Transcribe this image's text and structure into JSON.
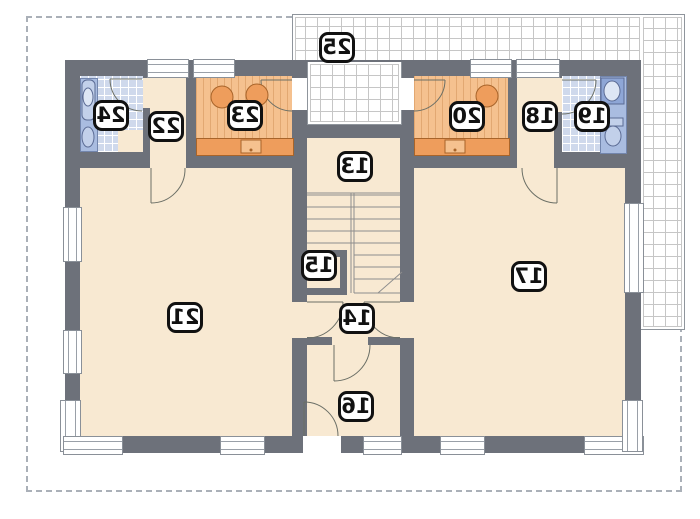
{
  "plan_type": "architectural floor plan (mirrored print)",
  "rooms": [
    {
      "id": "13",
      "label": "13"
    },
    {
      "id": "14",
      "label": "14"
    },
    {
      "id": "15",
      "label": "15"
    },
    {
      "id": "16",
      "label": "16"
    },
    {
      "id": "17",
      "label": "17"
    },
    {
      "id": "18",
      "label": "18"
    },
    {
      "id": "19",
      "label": "19"
    },
    {
      "id": "20",
      "label": "20"
    },
    {
      "id": "21",
      "label": "21"
    },
    {
      "id": "22",
      "label": "22"
    },
    {
      "id": "23",
      "label": "23"
    },
    {
      "id": "24",
      "label": "24"
    },
    {
      "id": "25",
      "label": "25"
    }
  ],
  "colors": {
    "wall": "#6d717a",
    "floor": "#f8e9d2",
    "kitchen": "#f5c18f",
    "kitchen_dark": "#ee9d5c",
    "tile_blue": "#cfd9ec",
    "fixture_blue": "#a9bce0",
    "terrace_grid": "#c6c6c6",
    "dash": "#aab0b8",
    "outline": "#5a5f66",
    "badge_border": "#111111"
  }
}
